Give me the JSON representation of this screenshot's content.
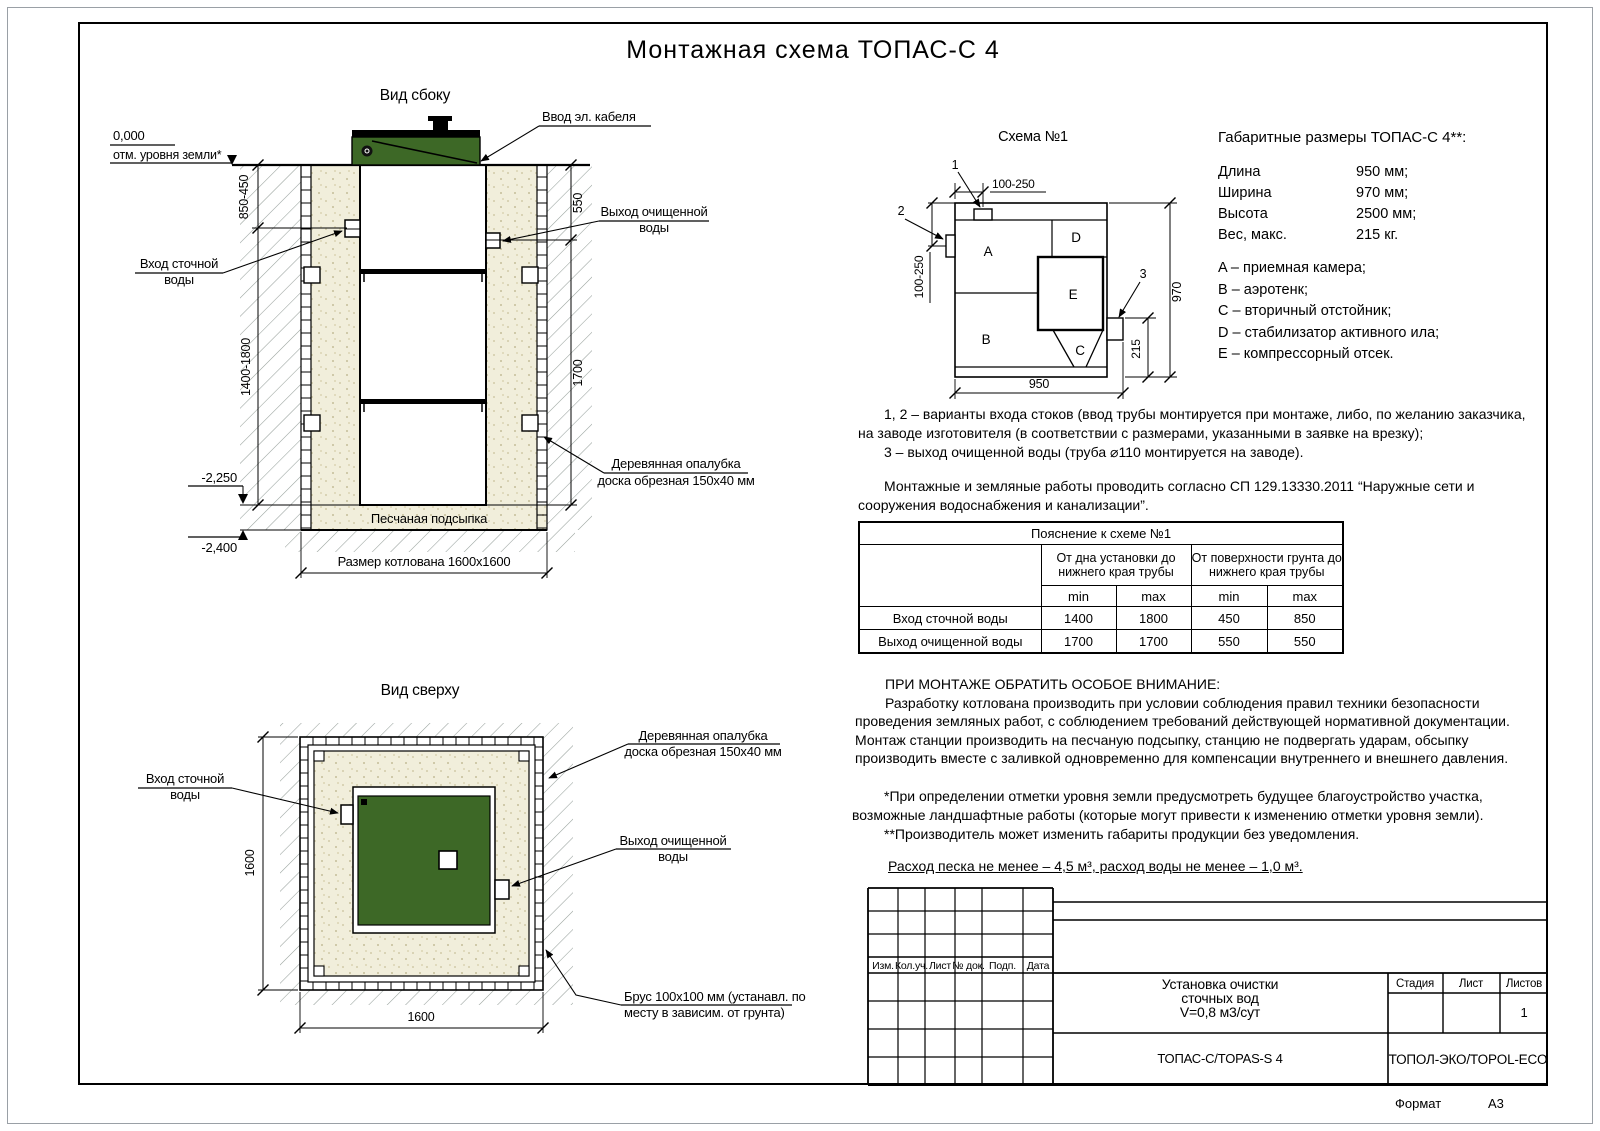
{
  "page": {
    "title": "Монтажная схема ТОПАС-С 4"
  },
  "colors": {
    "green": "#3d6826",
    "sand": "#f1eedb",
    "hatch_line": "#97a09b"
  },
  "shared": {
    "inlet_l1": "Вход сточной",
    "inlet_l2": "воды",
    "outlet_l1": "Выход очищенной",
    "outlet_l2": "воды",
    "formwork_l1": "Деревянная опалубка",
    "formwork_l2": "доска обрезная 150x40 мм"
  },
  "side_view": {
    "title": "Вид сбоку",
    "cable_label": "Ввод эл. кабеля",
    "zero_mark": "0,000",
    "ground_label": "отм. уровня земли*",
    "sand_bed": "Песчаная подсыпка",
    "pit_dim": "Размер котлована 1600x1600",
    "dim_in_top": "850-450",
    "dim_out_top": "550",
    "dim_in_bottom": "1400-1800",
    "dim_out_bottom": "1700",
    "lvl_bottom": "-2,250",
    "lvl_pit": "-2,400"
  },
  "top_view": {
    "title": "Вид сверху",
    "brus_l1": "Брус 100x100 мм (устанавл. по",
    "brus_l2": "месту в зависим. от грунта)",
    "dim_w": "1600",
    "dim_h": "1600"
  },
  "schema": {
    "title": "Схема №1",
    "comp_a": "A",
    "comp_b": "B",
    "comp_c": "C",
    "comp_d": "D",
    "comp_e": "E",
    "callout_1": "1",
    "callout_2": "2",
    "callout_3": "3",
    "dim_top": "100-250",
    "dim_left": "100-250",
    "dim_right": "970",
    "dim_outlet": "215",
    "dim_bottom": "950"
  },
  "specs": {
    "title": "Габаритные размеры ТОПАС-С 4**:",
    "rows": [
      {
        "label": "Длина",
        "value": "950 мм;"
      },
      {
        "label": "Ширина",
        "value": "970 мм;"
      },
      {
        "label": "Высота",
        "value": "2500 мм;"
      },
      {
        "label": "Вес, макс.",
        "value": "215 кг."
      }
    ]
  },
  "legend": {
    "items": [
      "A – приемная камера;",
      "B – аэротенк;",
      "C – вторичный отстойник;",
      "D – стабилизатор активного ила;",
      "E – компрессорный отсек."
    ]
  },
  "notes": {
    "n12": "1, 2 – варианты входа стоков (ввод трубы монтируется при монтаже, либо, по желанию заказчика, на заводе изготовителя (в соответствии с размерами, указанными в заявке на врезку);",
    "n3": "3 – выход очищенной воды (труба ⌀110 монтируется на заводе).",
    "sp": "Монтажные и земляные работы проводить согласно СП 129.13330.2011 “Наружные сети и сооружения водоснабжения и канализации”."
  },
  "table": {
    "title": "Пояснение к схеме №1",
    "group1": "От дна установки до нижнего края трубы",
    "group2": "От поверхности грунта до нижнего края трубы",
    "min": "min",
    "max": "max",
    "rows": [
      {
        "label": "Вход сточной воды",
        "v1": "1400",
        "v2": "1800",
        "v3": "450",
        "v4": "850"
      },
      {
        "label": "Выход очищенной воды",
        "v1": "1700",
        "v2": "1700",
        "v3": "550",
        "v4": "550"
      }
    ]
  },
  "warning": {
    "heading": "ПРИ МОНТАЖЕ ОБРАТИТЬ ОСОБОЕ ВНИМАНИЕ:",
    "body": "Разработку котлована производить при условии соблюдения правил техники безопасности проведения земляных работ, с соблюдением требований действующей нормативной документации. Монтаж станции производить на песчаную подсыпку, станцию не подвергать ударам, обсыпку производить вместе с заливкой одновременно для компенсации внутреннего и внешнего давления."
  },
  "footnotes": {
    "f1": "*При определении отметки уровня земли предусмотреть будущее благоустройство участка, возможные ландшафтные работы (которые могут привести к изменению отметки уровня земли).",
    "f2": "**Производитель может изменить габариты продукции без уведомления.",
    "consumption": "Расход песка не менее – 4,5 м³, расход воды не менее – 1,0 м³."
  },
  "stamp": {
    "rev_cols": [
      "Изм.",
      "Кол.уч.",
      "Лист",
      "№ док.",
      "Подп.",
      "Дата"
    ],
    "project_l1": "Установка очистки",
    "project_l2": "сточных вод",
    "project_l3": "V=0,8 м3/сут",
    "model": "ТОПАС-С/TOPAS-S 4",
    "company": "ТОПОЛ-ЭКО/TOPOL-ECO",
    "stage": "Стадия",
    "sheet": "Лист",
    "sheets": "Листов",
    "sheets_value": "1",
    "format_label": "Формат",
    "format_value": "А3"
  }
}
